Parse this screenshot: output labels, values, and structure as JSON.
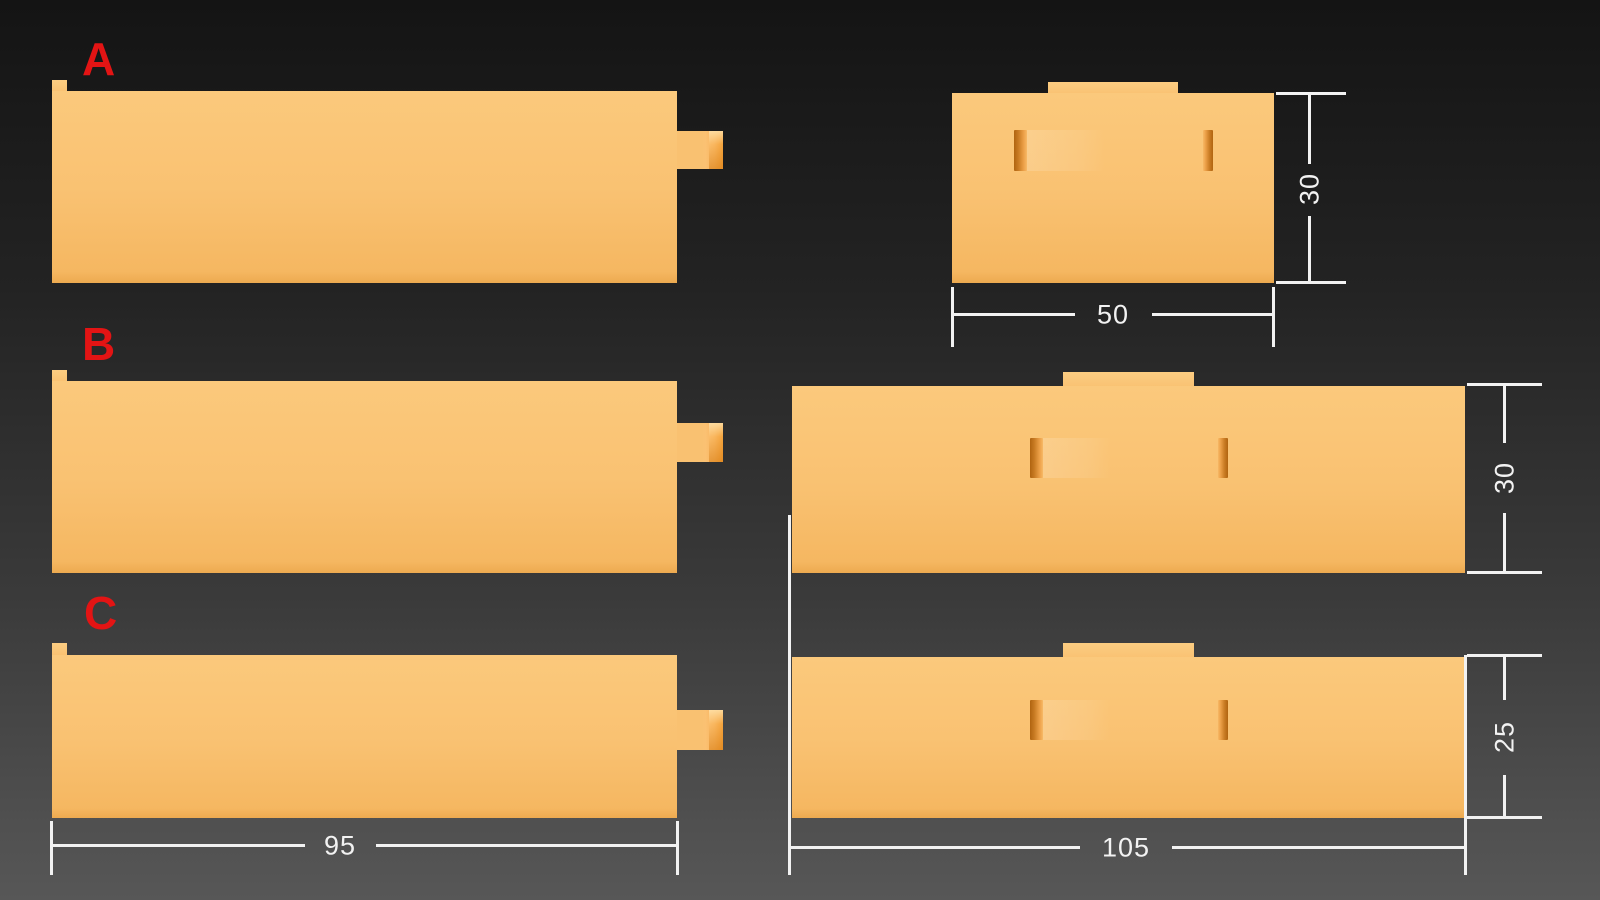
{
  "scene": {
    "type": "3d-render-part-comparison",
    "background_top": "#141414",
    "background_bottom": "#575757"
  },
  "variants": {
    "a": {
      "label": "A",
      "height": "30",
      "front_width": "50"
    },
    "b": {
      "label": "B",
      "height": "30"
    },
    "c": {
      "label": "C",
      "height": "25"
    }
  },
  "dimensions": {
    "side_length": "95",
    "front_length": "105"
  },
  "colors": {
    "part_fill": "#f9c171",
    "label_red": "#e31414",
    "dimension_white": "#f2f2f2"
  }
}
